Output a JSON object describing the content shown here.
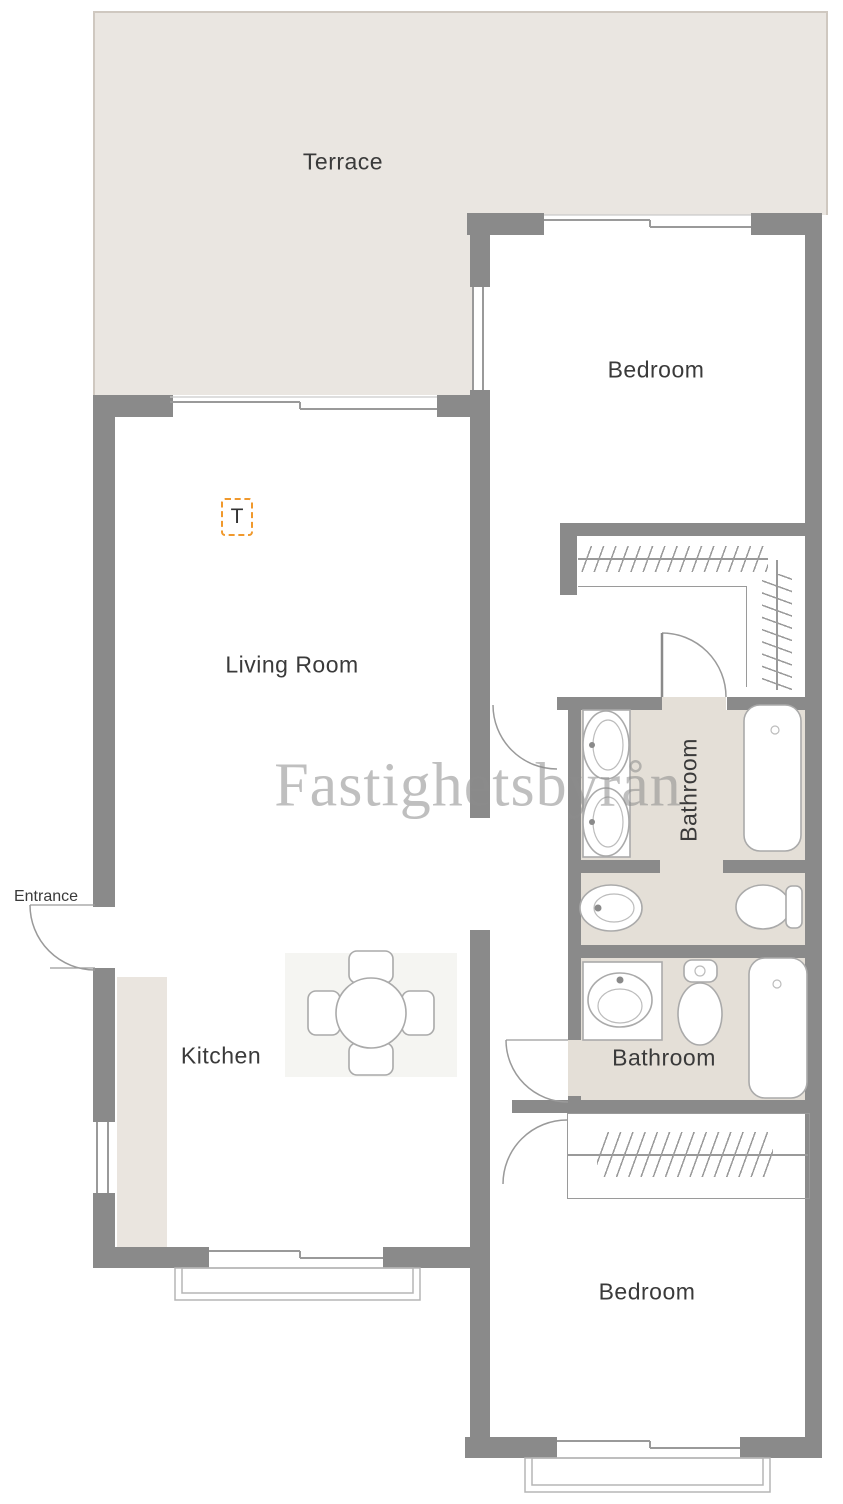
{
  "watermark": "Fastighetsbyrån",
  "labels": {
    "terrace": "Terrace",
    "bedroom_top": "Bedroom",
    "living_room": "Living Room",
    "kitchen": "Kitchen",
    "bathroom_top": "Bathroom",
    "bathroom_bottom": "Bathroom",
    "bedroom_bottom": "Bedroom",
    "entrance": "Entrance",
    "tv_marker": "T"
  },
  "colors": {
    "wall": "#8a8a8a",
    "terrace_floor": "#eae6e1",
    "bathroom_floor": "#e4dfd7",
    "kitchen_counter": "#eae5df",
    "dining_mat": "#f5f5f2",
    "line": "#9a9a9a",
    "fixture_line": "#aaaaaa",
    "label_text": "#3a3a3a",
    "marker_orange": "#f0992d",
    "watermark_gray": "#8c8c8c"
  },
  "fixtures": [
    "double-sink",
    "bathtub",
    "bidet",
    "toilet",
    "sink",
    "dining-table",
    "wardrobe-rail",
    "door-arc",
    "window"
  ]
}
